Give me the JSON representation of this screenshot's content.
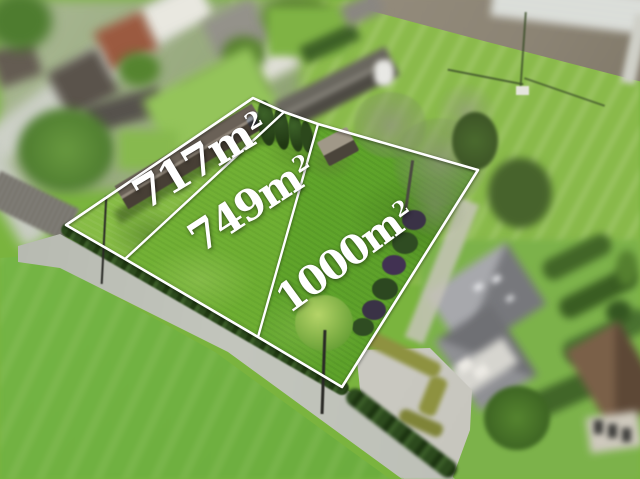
{
  "annotation": {
    "line_color": "#ffffff",
    "labels": [
      {
        "text": "717m",
        "sup": "2"
      },
      {
        "text": "749m",
        "sup": "2"
      },
      {
        "text": "1000m",
        "sup": "2"
      }
    ]
  },
  "palette": {
    "grass_parcel_1": "#79b23a",
    "grass_parcel_2": "#6bad30",
    "grass_parcel_3": "#5fa42a",
    "meadow": "#6fb040",
    "field_top_right": "#88b94a",
    "plowed_field": "#928a7a",
    "road": "#b9bcb4",
    "hedge": "#2c4a1d",
    "label_color": "#ffffff",
    "line_color": "#ffffff"
  }
}
